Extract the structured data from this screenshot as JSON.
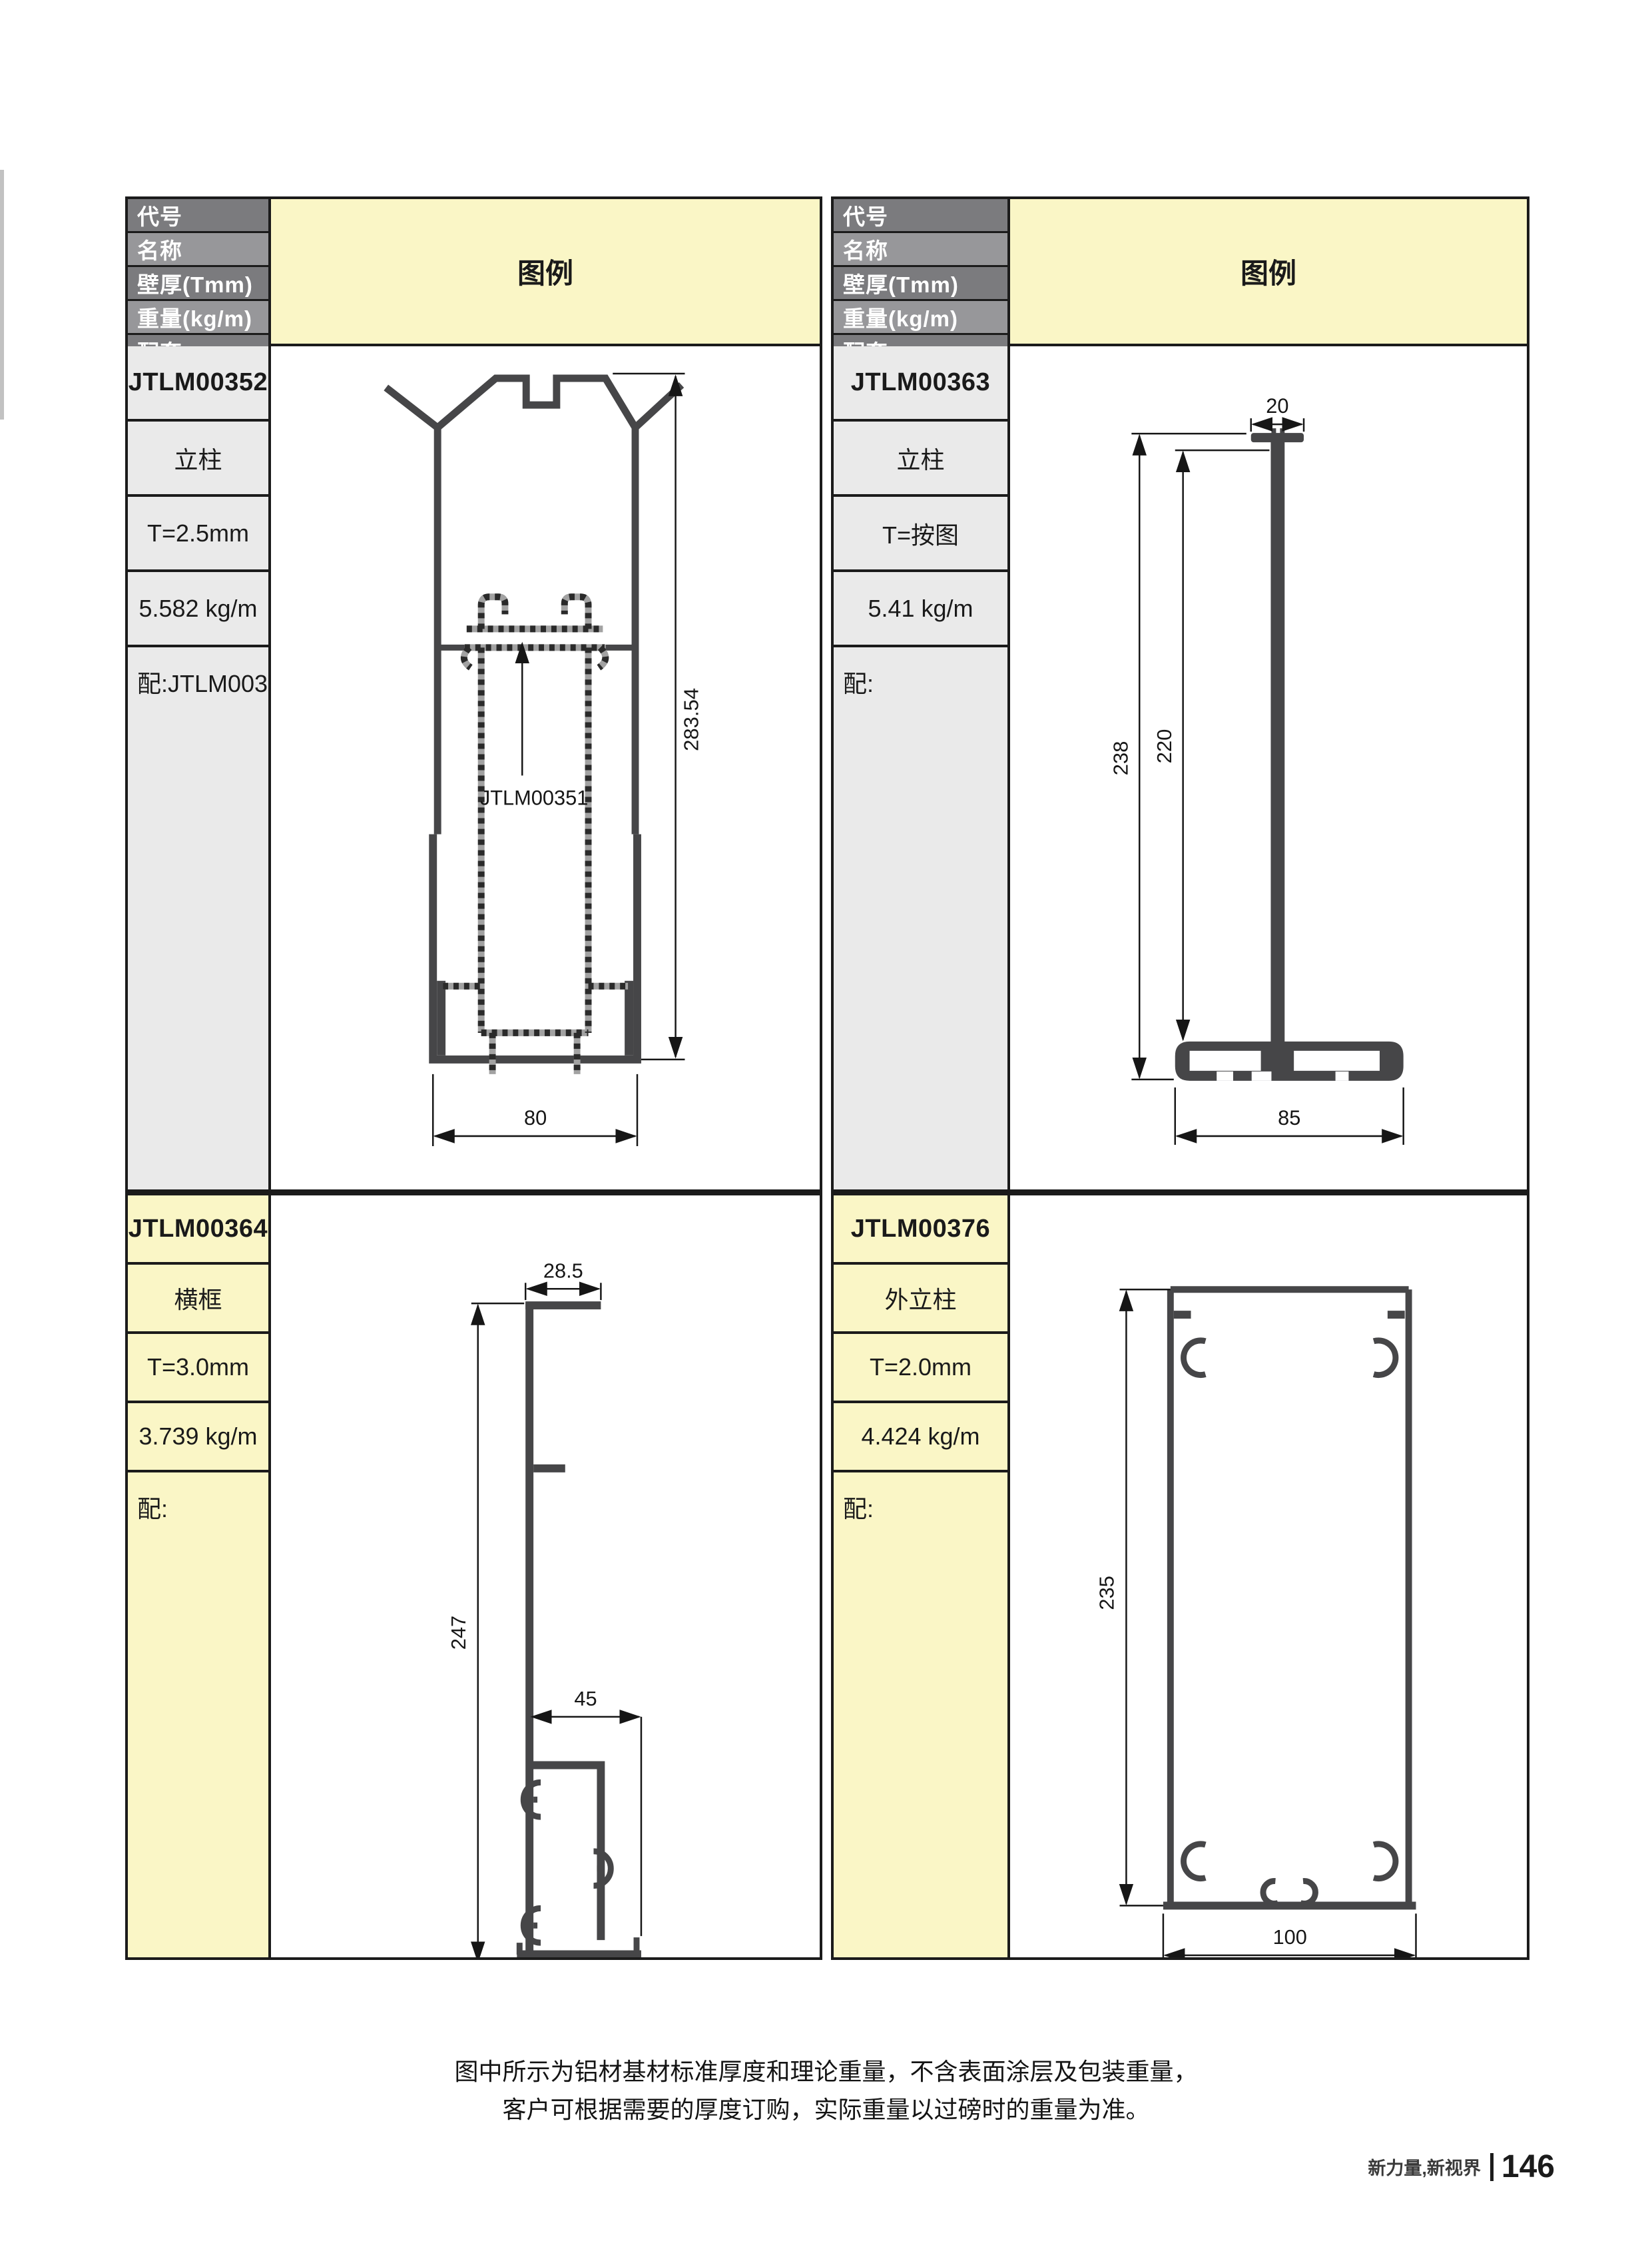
{
  "table": {
    "row_headers": [
      "代号",
      "名称",
      "壁厚(Tmm)",
      "重量(kg/m)",
      "配套"
    ],
    "legend_header": "图例"
  },
  "profiles": [
    {
      "id": "JTLM00352",
      "name": "立柱",
      "thickness": "T=2.5mm",
      "weight": "5.582 kg/m",
      "match": "配:JTLM00351",
      "dims": {
        "height": "283.54",
        "width": "80",
        "inner_profile": "JTLM00351"
      }
    },
    {
      "id": "JTLM00363",
      "name": "立柱",
      "thickness": "T=按图",
      "weight": "5.41 kg/m",
      "match": "配:",
      "dims": {
        "cap_width": "20",
        "overall_height": "238",
        "stem_height": "220",
        "base_width": "85"
      }
    },
    {
      "id": "JTLM00364",
      "name": "横框",
      "thickness": "T=3.0mm",
      "weight": "3.739 kg/m",
      "match": "配:",
      "dims": {
        "flange_width": "28.5",
        "height": "247",
        "base_width": "45"
      }
    },
    {
      "id": "JTLM00376",
      "name": "外立柱",
      "thickness": "T=2.0mm",
      "weight": "4.424 kg/m",
      "match": "配:",
      "dims": {
        "height": "235",
        "width": "100"
      }
    }
  ],
  "footer": {
    "note_line1": "图中所示为铝材基材标准厚度和理论重量，不含表面涂层及包装重量，",
    "note_line2": "客户可根据需要的厚度订购，实际重量以过磅时的重量为准。",
    "brand": "新力量,新视界",
    "page_number": "146"
  },
  "colors": {
    "legend_bg": "#faf6c6",
    "cell_gray": "#eaeaea",
    "header_dark": "#7b7b7e",
    "header_light": "#97979a",
    "profile_dark": "#464648",
    "dashed_gray": "#a2a2a2"
  }
}
